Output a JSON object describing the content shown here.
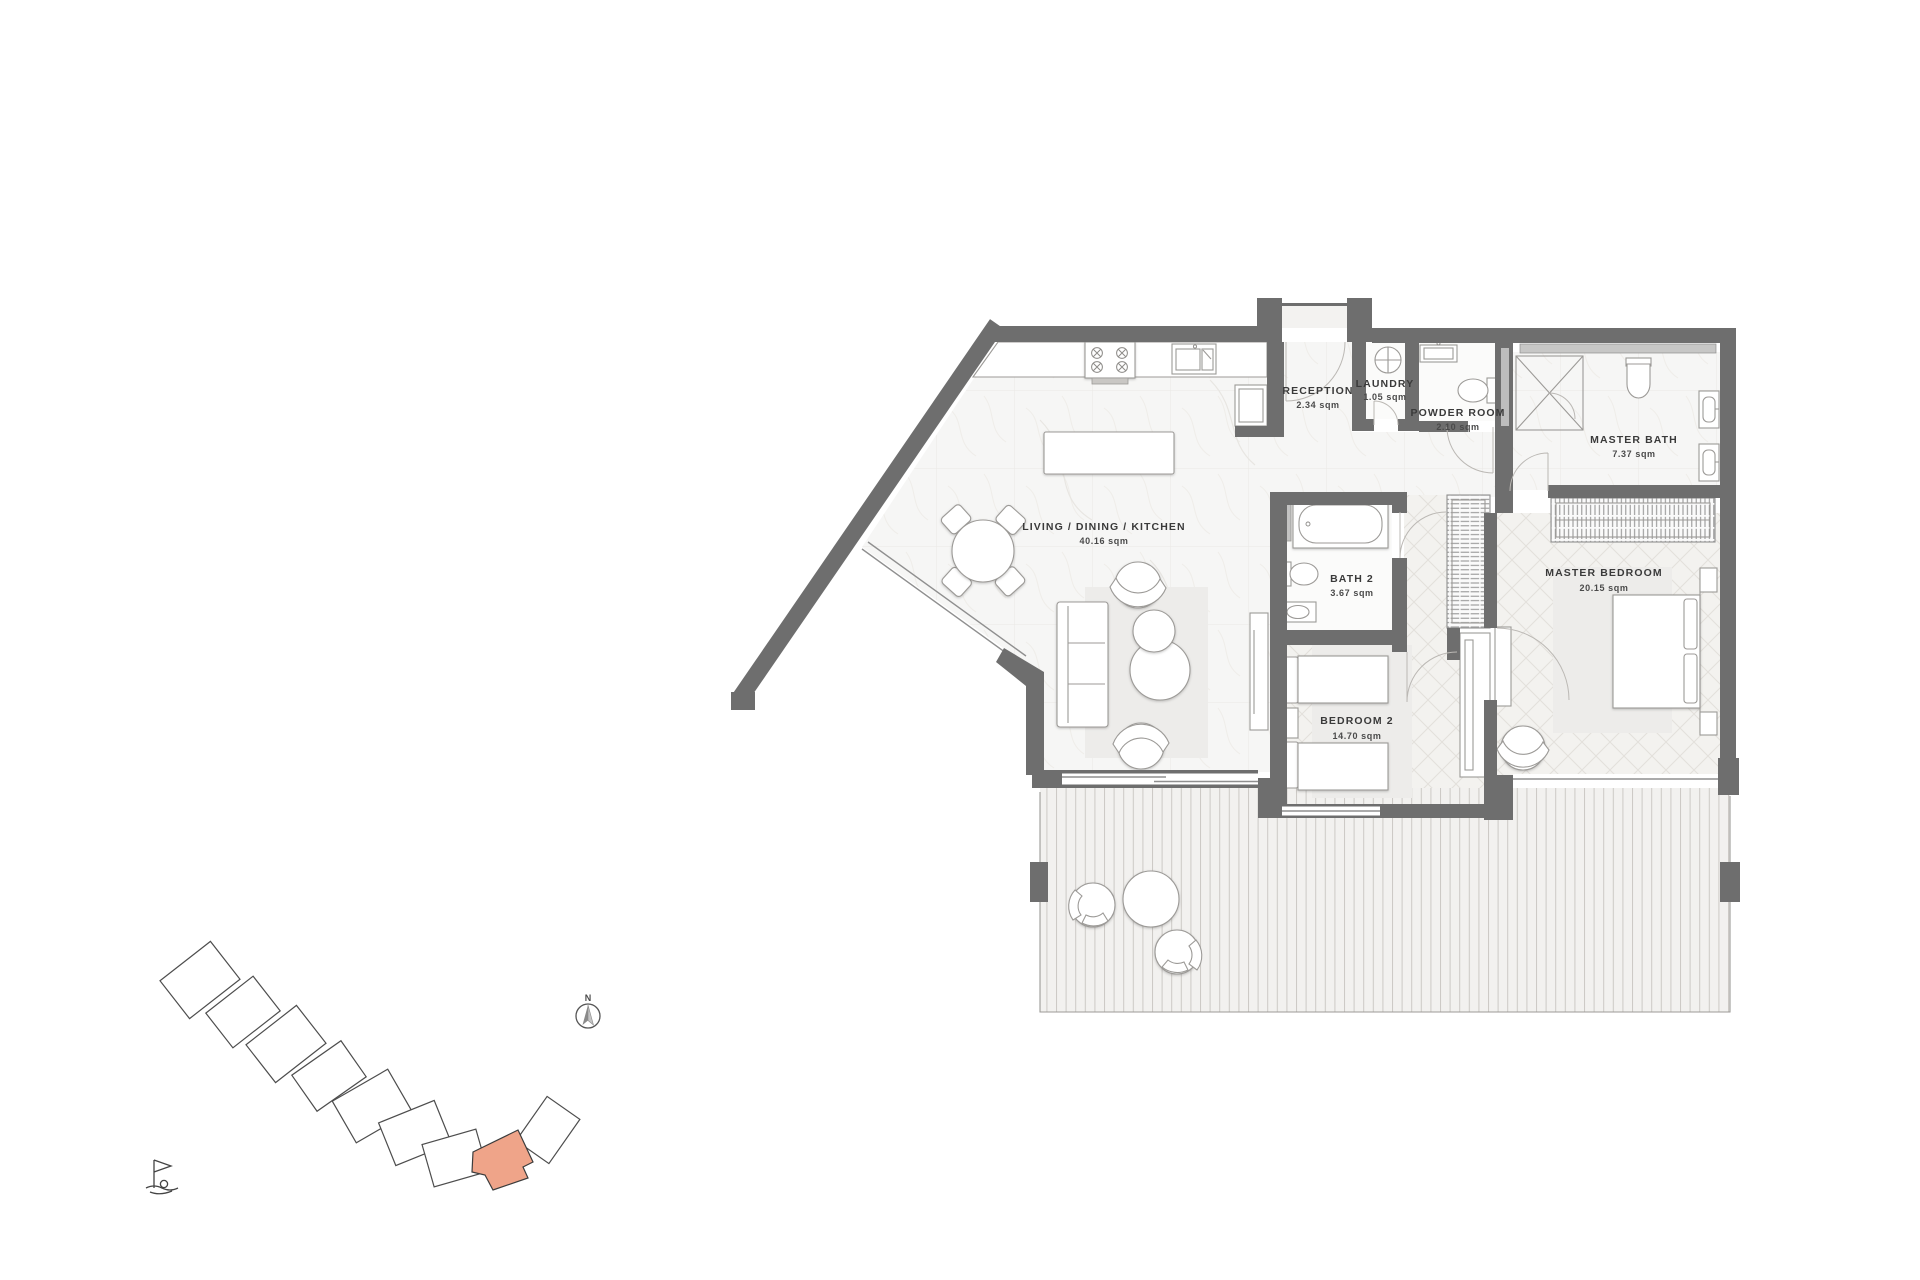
{
  "title": "Apartment floor plan",
  "rooms": [
    {
      "id": "living",
      "name": "LIVING / DINING / KITCHEN",
      "area": "40.16 sqm"
    },
    {
      "id": "reception",
      "name": "RECEPTION",
      "area": "2.34 sqm"
    },
    {
      "id": "laundry",
      "name": "LAUNDRY",
      "area": "1.05 sqm"
    },
    {
      "id": "powder_room",
      "name": "POWDER ROOM",
      "area": "2.10 sqm"
    },
    {
      "id": "master_bath",
      "name": "MASTER BATH",
      "area": "7.37 sqm"
    },
    {
      "id": "bath_2",
      "name": "BATH 2",
      "area": "3.67 sqm"
    },
    {
      "id": "master_bedroom",
      "name": "MASTER BEDROOM",
      "area": "20.15 sqm"
    },
    {
      "id": "bedroom_2",
      "name": "BEDROOM 2",
      "area": "14.70 sqm"
    }
  ],
  "compass": {
    "label": "N"
  },
  "key_plan": {
    "highlight_color": "#efa489"
  },
  "colors": {
    "wall": "#6e6e6e",
    "text": "#3a3a3a",
    "highlight": "#efa489"
  }
}
